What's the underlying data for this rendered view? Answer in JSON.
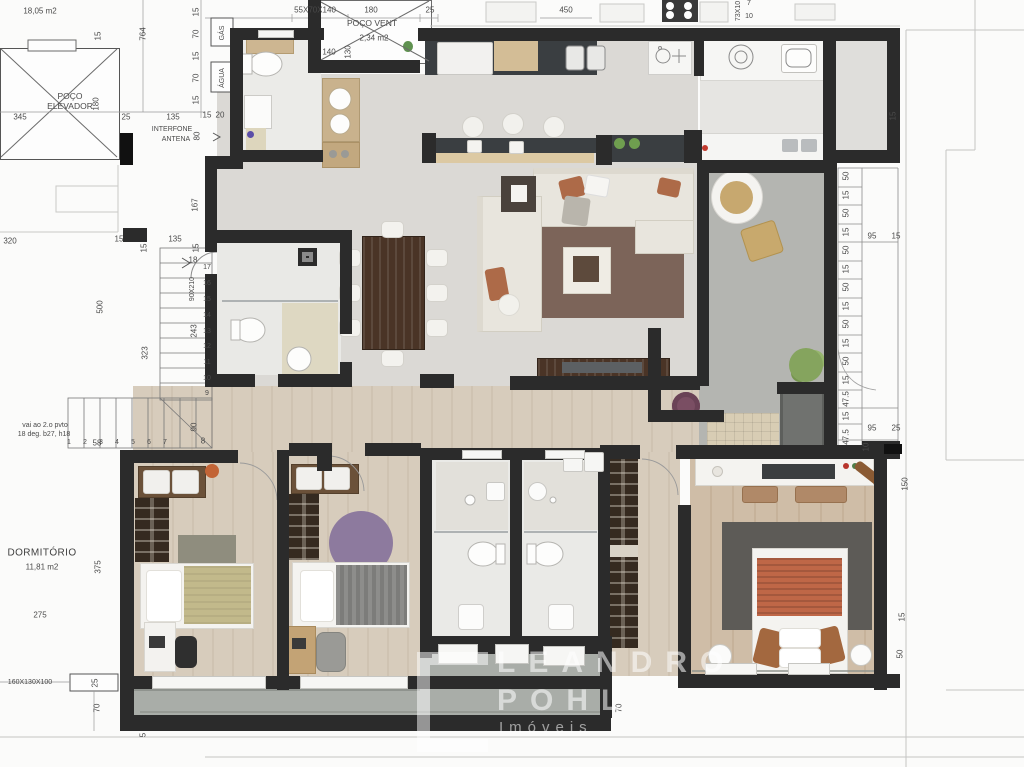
{
  "texts": {
    "area_small": "18,05 m2",
    "poco_elevador": "POÇO\nELEVADOR",
    "poco_vent": "POÇO VENT",
    "poco_vent_area": "2,34 m2",
    "dormitorio": "DORMITÓRIO",
    "dormitorio_area": "11,81 m2",
    "gas": "GÁS",
    "agua": "ÁGUA",
    "interfone": "INTERFONE",
    "antena": "ANTENA",
    "stair_note1": "vai ao 2.o pvto",
    "stair_note2": "18 deg. b27, h18",
    "cab_top": "55X70X140",
    "cab_bottom": "160X130X100",
    "door_size": "90X210",
    "stove_size": "73X10"
  },
  "dims": {
    "v5": "5",
    "v7": "7",
    "v8": "8",
    "v10": "10",
    "v15": "15",
    "v18": "18",
    "v20": "20",
    "v25": "25",
    "v47_5": "47.5",
    "v50": "50",
    "v58": "58",
    "v70": "70",
    "v80": "80",
    "v90": "90",
    "v95": "95",
    "v130": "130",
    "v135": "135",
    "v140": "140",
    "v150": "150",
    "v167": "167",
    "v180": "180",
    "v243": "243",
    "v275": "275",
    "v320": "320",
    "v323": "323",
    "v345": "345",
    "v375": "375",
    "v450": "450",
    "v500": "500",
    "v764": "764"
  },
  "stairs": {
    "run": [
      "1",
      "2",
      "3",
      "4",
      "5",
      "6",
      "7"
    ],
    "rise": [
      "9",
      "10",
      "11",
      "12",
      "13",
      "14",
      "15",
      "16",
      "17"
    ]
  },
  "watermark": {
    "line1": "LEANDRO",
    "line2": "POHL",
    "line3": "Imóveis"
  },
  "colors": {
    "wall": "#2b2b2b",
    "wood": "#d6cbbb",
    "terrace": "#b4b5b1",
    "rug_living": "#7c6459",
    "duvet": "#bf6747"
  }
}
